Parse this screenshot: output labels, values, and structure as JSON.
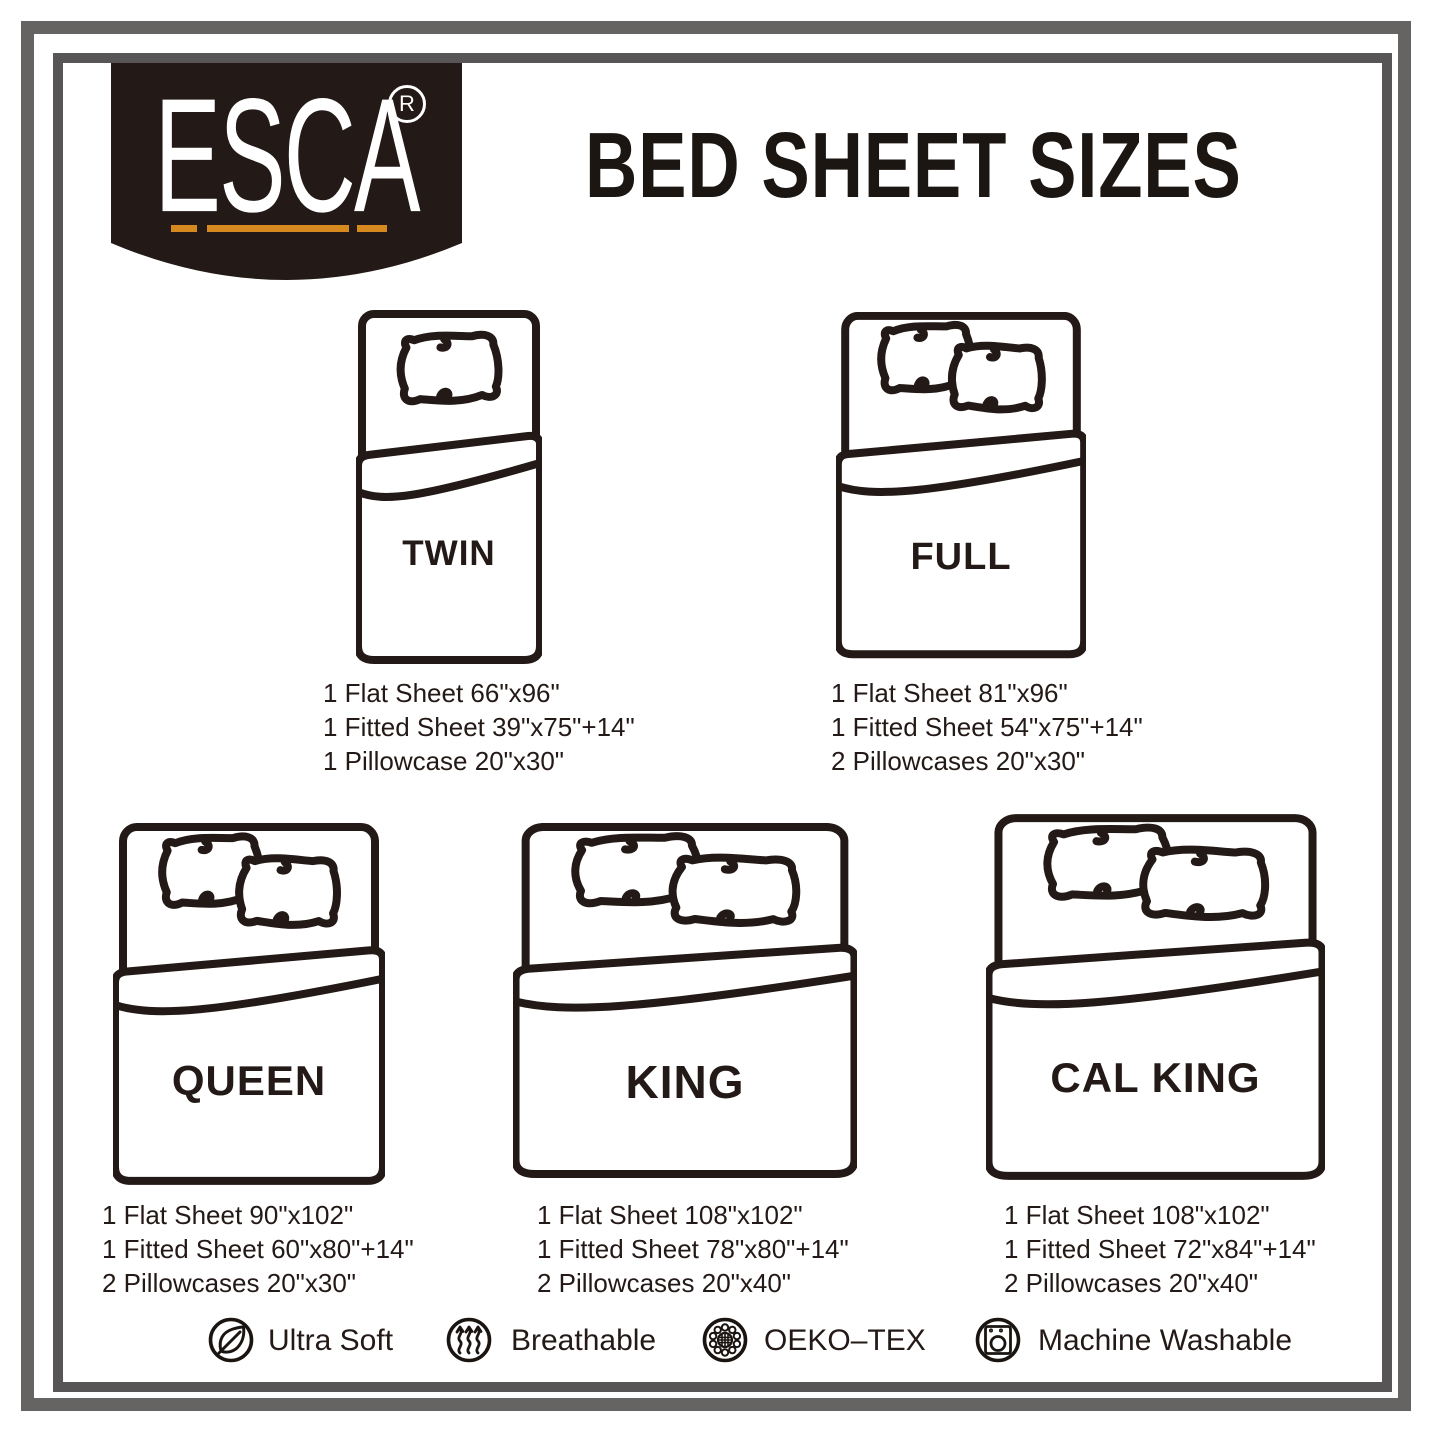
{
  "brand": {
    "name": "ESCA",
    "registered_mark": "R"
  },
  "title": "BED SHEET SIZES",
  "colors": {
    "ink": "#231916",
    "badge_background": "#231916",
    "accent_orange": "#d5891e",
    "frame_outer_gray": "#666463",
    "frame_inner_gray": "#575555",
    "background": "#ffffff"
  },
  "beds": [
    {
      "name": "TWIN",
      "pillows": 1,
      "specs": [
        "1 Flat Sheet 66\"x96\"",
        "1 Fitted Sheet 39\"x75\"+14\"",
        "1 Pillowcase 20\"x30\""
      ]
    },
    {
      "name": "FULL",
      "pillows": 2,
      "specs": [
        "1 Flat Sheet 81\"x96\"",
        "1 Fitted Sheet 54\"x75\"+14\"",
        "2 Pillowcases 20\"x30\""
      ]
    },
    {
      "name": "QUEEN",
      "pillows": 2,
      "specs": [
        "1 Flat Sheet 90\"x102\"",
        "1 Fitted Sheet 60\"x80\"+14\"",
        "2 Pillowcases 20\"x30\""
      ]
    },
    {
      "name": "KING",
      "pillows": 2,
      "specs": [
        "1 Flat Sheet 108\"x102\"",
        "1 Fitted Sheet 78\"x80\"+14\"",
        "2 Pillowcases 20\"x40\""
      ]
    },
    {
      "name": "CAL KING",
      "pillows": 2,
      "specs": [
        "1 Flat Sheet 108\"x102\"",
        "1 Fitted Sheet 72\"x84\"+14\"",
        "2 Pillowcases 20\"x40\""
      ]
    }
  ],
  "features": [
    {
      "icon": "leaf-icon",
      "label": "Ultra Soft"
    },
    {
      "icon": "breathable-waves-icon",
      "label": "Breathable"
    },
    {
      "icon": "oeko-tex-flower-icon",
      "label": "OEKO–TEX"
    },
    {
      "icon": "washing-machine-icon",
      "label": "Machine Washable"
    }
  ]
}
